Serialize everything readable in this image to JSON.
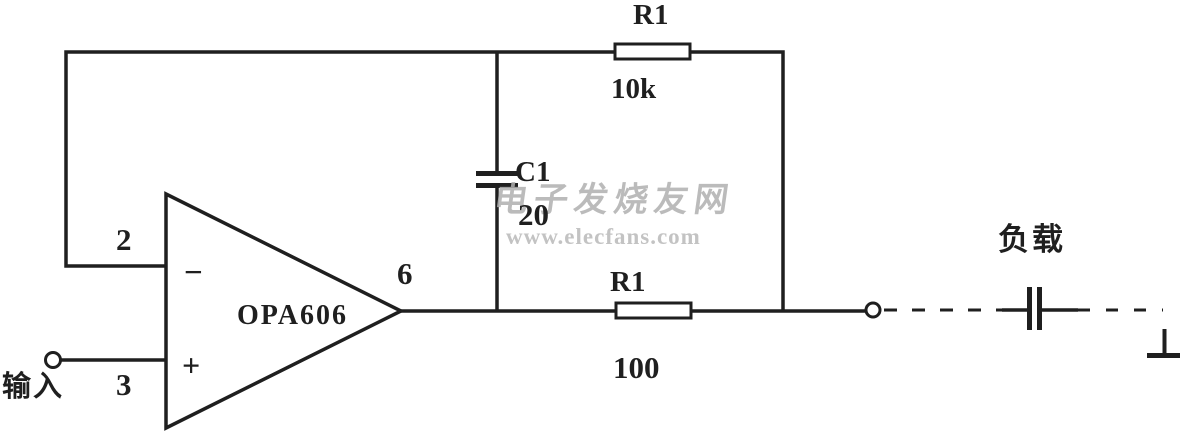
{
  "figure": {
    "type": "circuit-schematic",
    "background_color": "#ffffff",
    "ink_color": "#1f1f1f",
    "opamp": {
      "name": "OPA606",
      "inverting_pin": "2",
      "noninverting_pin": "3",
      "output_pin": "6",
      "minus_sign": "−",
      "plus_sign": "+"
    },
    "components": {
      "feedback_resistor": {
        "ref": "R1",
        "value": "10k"
      },
      "feedback_capacitor": {
        "ref": "C1",
        "value": "20"
      },
      "series_resistor": {
        "ref": "R1",
        "value": "100"
      }
    },
    "terminals": {
      "input_label": "输入",
      "load_label": "负载"
    },
    "watermark": {
      "text_zh": "电子发烧友网",
      "text_url": "www.elecfans.com",
      "color": "#b3b3b3"
    }
  }
}
